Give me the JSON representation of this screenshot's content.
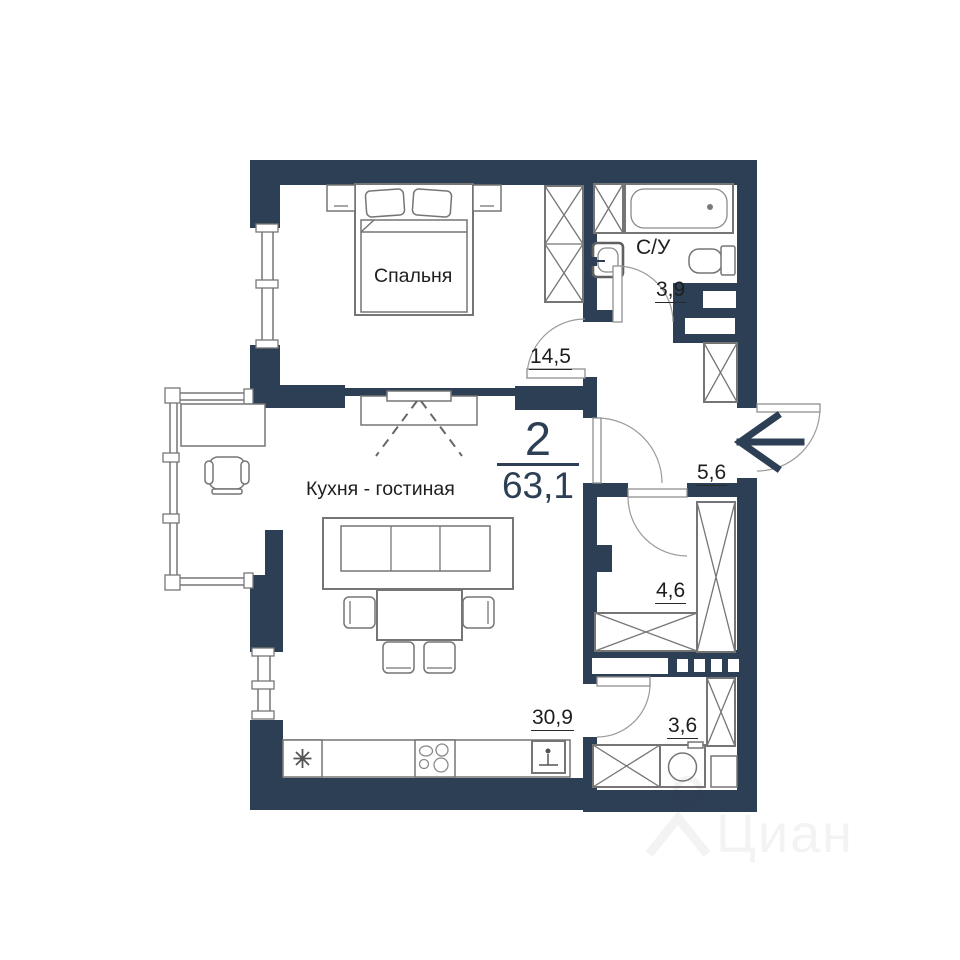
{
  "plan_summary": {
    "rooms_count": "2",
    "total_area": "63,1"
  },
  "rooms": {
    "bedroom": {
      "label": "Спальня",
      "area": "14,5"
    },
    "kitchen_living": {
      "label": "Кухня - гостиная",
      "area": "30,9"
    },
    "bathroom": {
      "label": "С/У",
      "area": "3,9"
    },
    "hallway": {
      "area": "5,6"
    },
    "storage": {
      "area": "4,6"
    },
    "laundry": {
      "area": "3,6"
    }
  },
  "watermark": {
    "text": "Циан"
  },
  "colors": {
    "wall": "#2d3f54",
    "outline": "#757575",
    "label": "#1d1d1d"
  }
}
